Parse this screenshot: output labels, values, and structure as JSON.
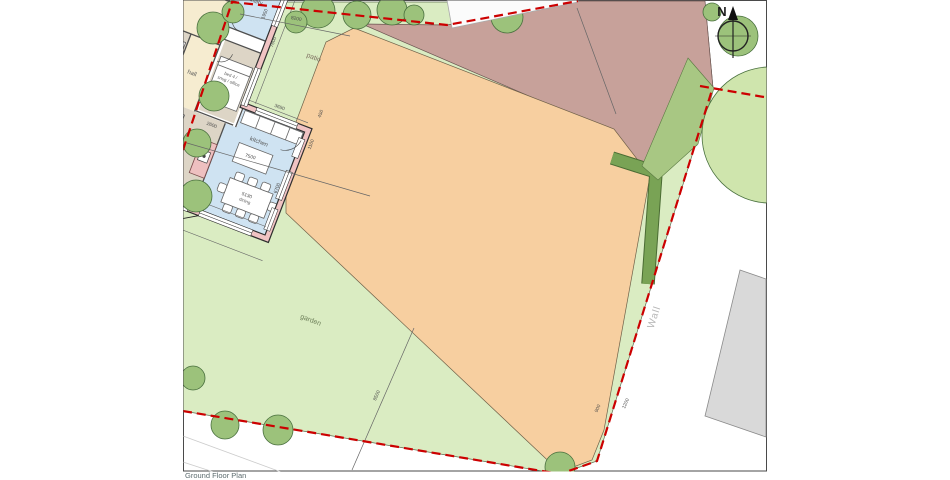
{
  "title": "Ground Floor Plan",
  "compass": {
    "north": "N"
  },
  "rooms": {
    "bed1": "bed 1",
    "bed2": "bed 2",
    "bed3": "bed 3",
    "bed4_line1": "bed 4 /",
    "bed4_line2": "snug / office",
    "bathroom": "bathroom",
    "wc": "WC",
    "lobby": "lobby",
    "utility": "utility",
    "ensuite": "ensuite",
    "hall": "hall",
    "living": "living",
    "kitchen": "kitchen",
    "dining": "dining"
  },
  "areas": {
    "garden": "garden",
    "gravel": "gravel",
    "carport": "carport",
    "patio": "patio",
    "bins": "bins",
    "wall": "Wall",
    "front_door_line1": "front",
    "front_door_line2": "door"
  },
  "dimensions": {
    "d8200": "8200",
    "d7500": "7500",
    "d8500": "8500",
    "d7200": "7200",
    "d13950": "13950",
    "d6100": "6100",
    "d3500": "3500",
    "d2050": "2050",
    "d2400": "2400",
    "d1950": "1950",
    "d4850": "4850",
    "d4350": "4350",
    "d1600": "1600",
    "d2600": "2600",
    "d7600": "7600",
    "d3650": "3650",
    "d1100": "1100",
    "d450": "450",
    "d6700": "6700",
    "d10850": "10850",
    "d5130": "5130",
    "d11250": "11250",
    "d900": "900",
    "d1200": "1200"
  },
  "colors": {
    "boundary_red": "#cc0000",
    "garden_green": "#daecc2",
    "tree_green": "#9cc27b",
    "gravel_mauve": "#c7a19a",
    "patio_orange": "#f7cfa0",
    "wall_pink": "#f0c3c3",
    "room_beige": "#ddd5c6",
    "room_blue": "#cfe3f2",
    "room_cream": "#f6ecd0",
    "hedge_green": "#79a355",
    "road_gray": "#d9d9d9"
  }
}
